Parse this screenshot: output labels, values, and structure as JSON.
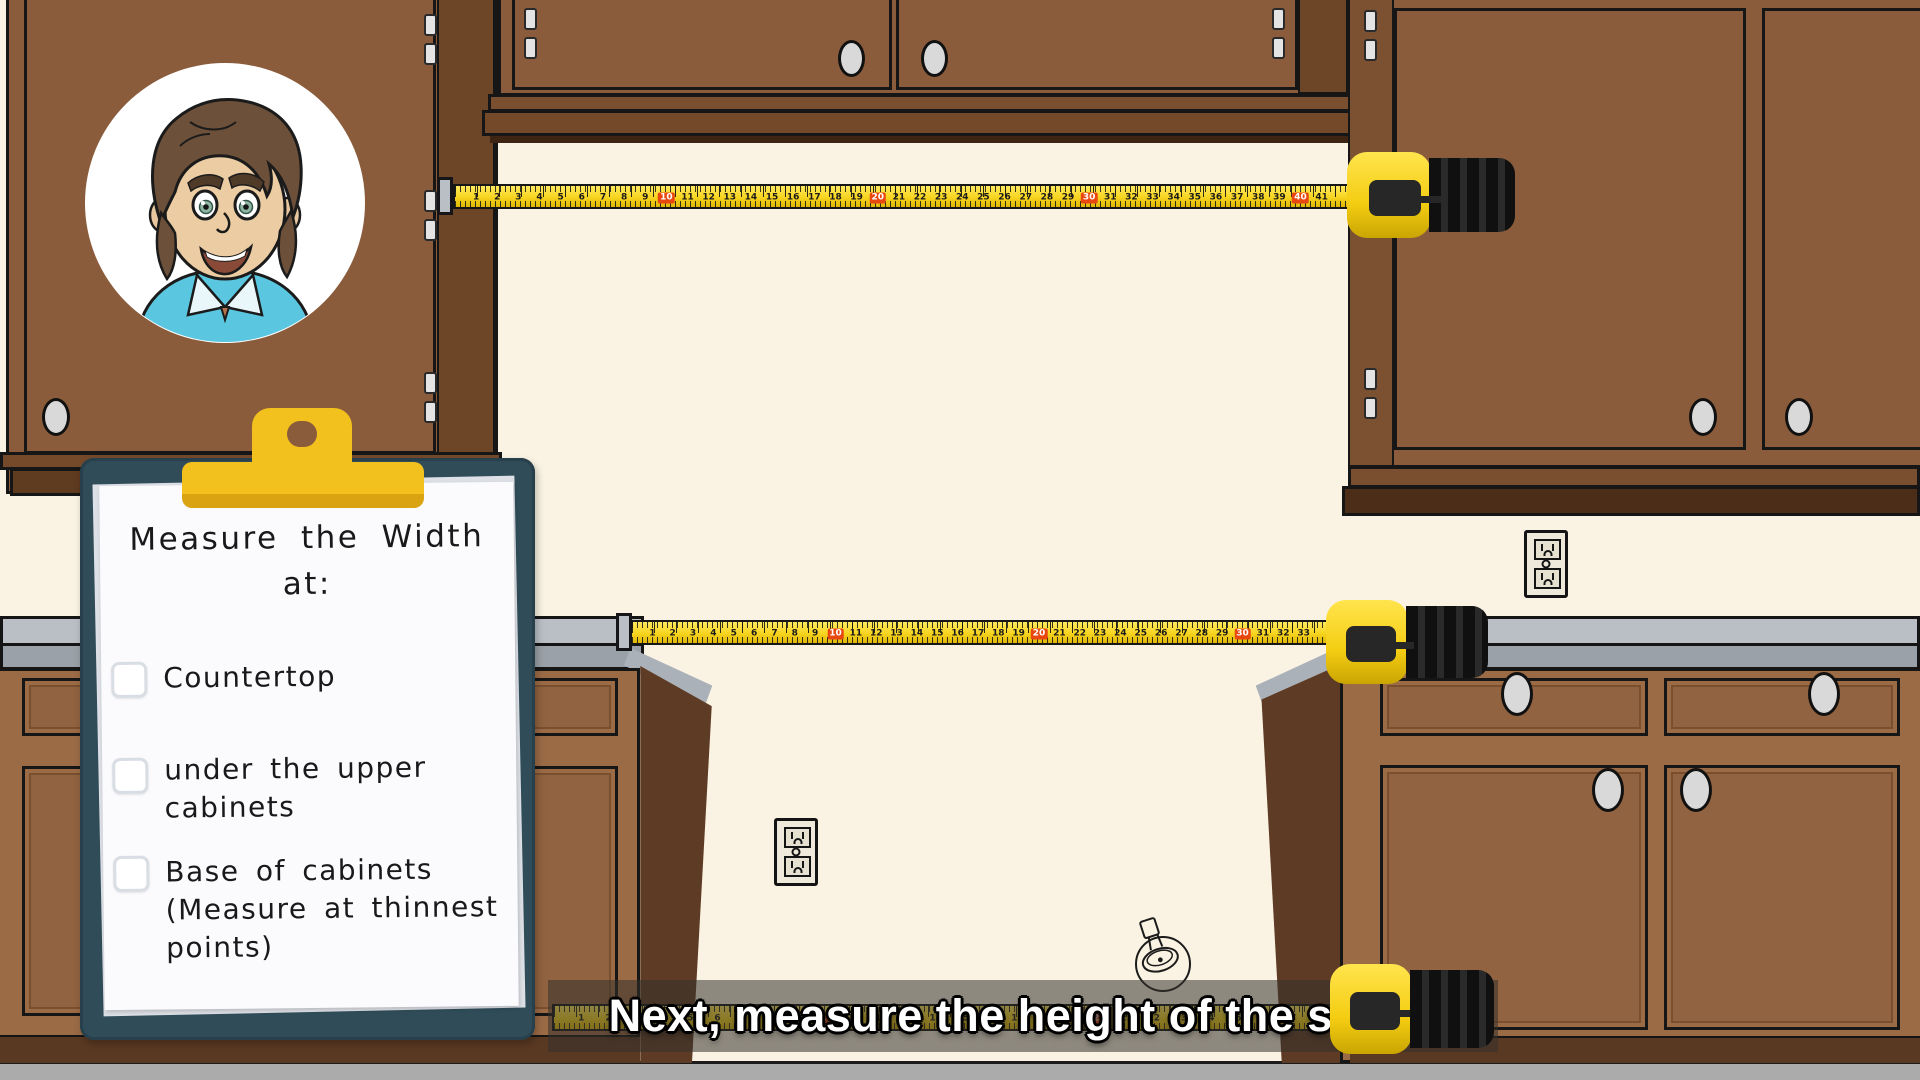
{
  "scene": {
    "caption": "Next, measure the height of the space"
  },
  "clipboard": {
    "title_line1": "Measure the Width",
    "title_line2": "at:",
    "items": [
      {
        "label": "Countertop",
        "checked": false
      },
      {
        "label": "under the upper cabinets",
        "checked": false
      },
      {
        "label": "Base of cabinets (Measure at thinnest points)",
        "checked": false
      }
    ]
  },
  "tapes": {
    "top": {
      "count": 41,
      "highlight_interval": 10
    },
    "middle": {
      "count": 33,
      "highlight_interval": 10
    },
    "bottom": {
      "count": 28,
      "highlight_interval": 10
    }
  },
  "icons": {
    "narrator_avatar": "cartoon-man-portrait",
    "outlet": "duplex-power-outlet",
    "fixture_sketch": "light-fixture-doodle",
    "tape_measure": "tape-measure"
  },
  "palette": {
    "wall": "#FAF3E3",
    "upper_cabinet": "#8A5C3B",
    "cabinet_side": "#6D4527",
    "base_cabinet": "#9B6B46",
    "countertop": "#B9BFC5",
    "floor": "#ABABAB",
    "tape_yellow": "#F6D41F",
    "tape_highlight_red": "#E8480F",
    "clipboard_teal": "#2F4C58",
    "clip_yellow": "#F3C11E",
    "caption_color": "#FFFFFF"
  }
}
